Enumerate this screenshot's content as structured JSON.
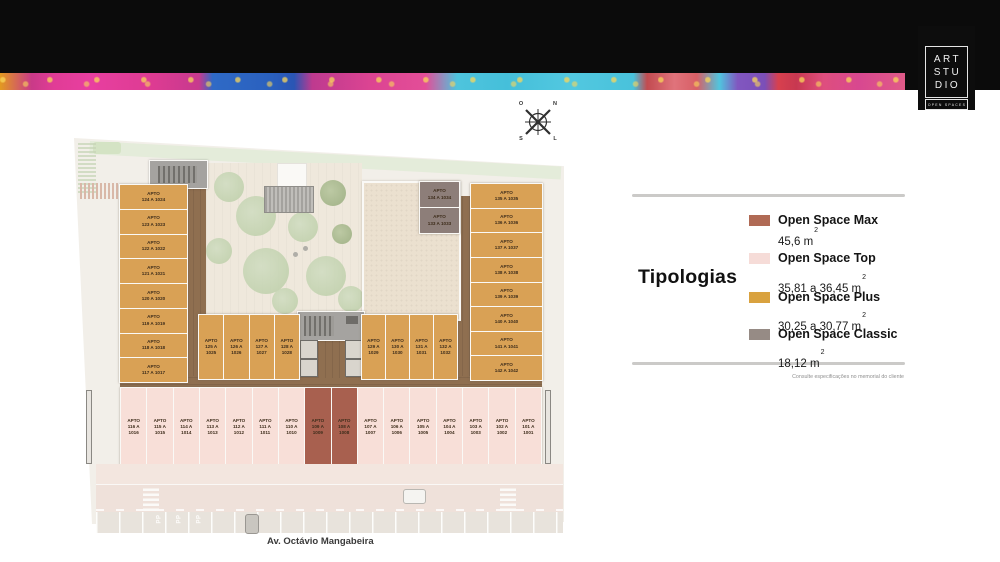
{
  "banner": {
    "logo": {
      "lines": [
        "ART",
        "STU",
        "DIO"
      ],
      "subtitle": "OPEN SPACES"
    }
  },
  "compass": {
    "west": "O",
    "north": "N",
    "south": "S",
    "east": "L"
  },
  "legend": {
    "title": "Tipologias",
    "items": [
      {
        "name": "Open Space Max",
        "area": "45,6 m",
        "sup": "2",
        "color": "#B06A55"
      },
      {
        "name": "Open Space Top",
        "area": "35,81 a 36,45 m",
        "sup": "2",
        "color": "#F6DCD8"
      },
      {
        "name": "Open Space Plus",
        "area": "30,25 a 30,77 m",
        "sup": "2",
        "color": "#D9A23F"
      },
      {
        "name": "Open Space Classic",
        "area": "18,12 m",
        "sup": "2",
        "color": "#968B85"
      }
    ],
    "footnote": "Consulte especificações no memorial do cliente"
  },
  "plan": {
    "street_label": "Av. Octávio Mangabeira",
    "parking_marking": "PP",
    "apto_prefix": "APTO",
    "typology_colors": {
      "max": "#A8604F",
      "top": "#F8DFD8",
      "plus": "#D9A155",
      "classic": "#8D7E79"
    },
    "sections": {
      "left_column": [
        "124 A 1024",
        "123 A 1023",
        "122 A 1022",
        "121 A 1021",
        "120 A 1020",
        "119 A 1019",
        "118 A 1018",
        "117 A 1017"
      ],
      "middle_left_row": [
        "125 A 1025",
        "126 A 1026",
        "127 A 1027",
        "128 A 1028"
      ],
      "middle_right_row": [
        "129 A 1029",
        "130 A 1030",
        "131 A 1031",
        "132 A 1032"
      ],
      "right_column": [
        "135 A 1035",
        "136 A 1036",
        "137 A 1037",
        "138 A 1038",
        "139 A 1039",
        "140 A 1040",
        "141 A 1041",
        "142 A 1042"
      ],
      "classic_block": [
        "134 A 1034",
        "133 A 1033"
      ],
      "bottom_row": [
        {
          "unit": "116 A 1016",
          "type": "top"
        },
        {
          "unit": "115 A 1015",
          "type": "top"
        },
        {
          "unit": "114 A 1014",
          "type": "top"
        },
        {
          "unit": "113 A 1013",
          "type": "top"
        },
        {
          "unit": "112 A 1012",
          "type": "top"
        },
        {
          "unit": "111 A 1011",
          "type": "top"
        },
        {
          "unit": "110 A 1010",
          "type": "top"
        },
        {
          "unit": "109 A 1009",
          "type": "max"
        },
        {
          "unit": "108 A 1008",
          "type": "max"
        },
        {
          "unit": "107 A 1007",
          "type": "top"
        },
        {
          "unit": "106 A 1006",
          "type": "top"
        },
        {
          "unit": "105 A 1005",
          "type": "top"
        },
        {
          "unit": "104 A 1004",
          "type": "top"
        },
        {
          "unit": "103 A 1003",
          "type": "top"
        },
        {
          "unit": "102 A 1002",
          "type": "top"
        },
        {
          "unit": "101 A 1001",
          "type": "top"
        }
      ]
    }
  }
}
